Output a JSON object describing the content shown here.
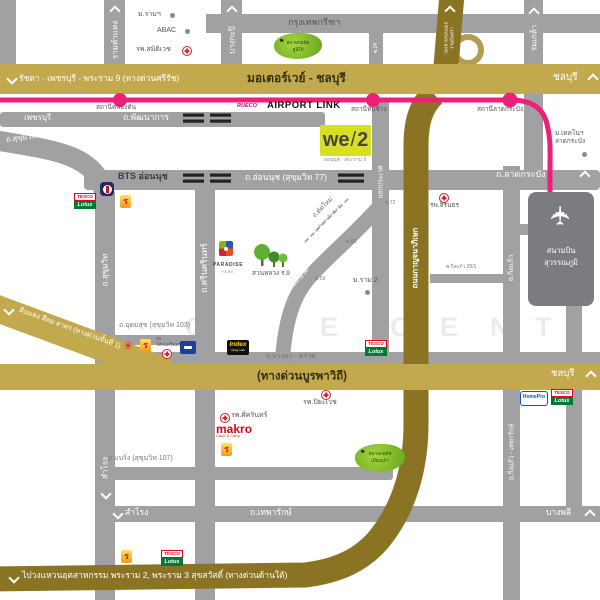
{
  "brand": {
    "we": "we",
    "slash": "/",
    "two": "2",
    "subtitle": "อ่อนนุช - พระราม 9"
  },
  "expressways": {
    "srirat": "รัชดา - เพชรบุรี - พระราม 9 (ทางด่วนศรีรัช)",
    "motorway": "มอเตอร์เวย์ - ชลบุรี",
    "chonburi": "ชลบุรี",
    "outer_ring_line1": "วงแหวนรอบนอก",
    "outer_ring_line2": "รามอินทรา",
    "kanchanaphisek": "ถนนกาญจนาภิเษก",
    "bangna_trat": "ถ.บางนา - ตราด",
    "burapha": "(ทางด่วนบูรพาวิถี)",
    "din_daeng": "ดินแดง สีลม สาทร (ทางด่วนขั้นที่ 1)",
    "industrial_ring": "ไปวงแหวนอุตสาหกรรม พระราม 2, พระราม 3 สุขสวัสดิ์ (ทางด่วนด้านใต้)"
  },
  "airport_link": {
    "label": "AIRPORT LINK",
    "brand": "RUECO",
    "station_khlong_tan": "สถานีคลองตัน",
    "station_thap_chang": "สถานีทับช้าง",
    "station_lat_krabang": "สถานีลาดกระบัง"
  },
  "roads": {
    "ramkhamhaeng": "รามคำแหง",
    "bangkapi": "บางกะปิ",
    "krungthep_kreetha": "กรุงเทพกรีฑา",
    "soi_24": "ซ.24",
    "rom_klao": "ร่มเกล้า",
    "phetchaburi": "เพชรบุรี",
    "phatthanakan": "ถ.พัฒนาการ",
    "sukhumvit": "ถ.สุขุมวิท",
    "on_nut": "ถ.อ่อนนุช (สุขุมวิท 77)",
    "bts_on_nut": "BTS อ่อนนุช",
    "srinagarindra": "ถ.ศรีนครินทร์",
    "lat_krabang": "ถ.ลาดกระบัง",
    "yaek_prawet": "แยกประเวศ",
    "tat_mai": "ถ.ตัดใหม่",
    "tat_mai_sub": "(เฉลิมพระเกียรติ ร.9)",
    "chalerm_prakiat": "เฉลิมพระเกียรติ",
    "soi_72": "ซ.72",
    "soi_62": "ซ.62",
    "soi_59": "ซ.59",
    "king_kaeo": "ถ.กิ่งแก้ว",
    "soi_king_kaeo": "ซ.กิ่งแก้ว 25/1",
    "udom_suk": "ถ.อุดมสุข (สุขุมวิท 103)",
    "bearing": "ถ.แบริ่ง (สุขุมวิท 107)",
    "thepharak": "ถ.เทพารักษ์",
    "samrong": "สำโรง",
    "bang_phli": "บางพลี",
    "king_kaeo_thepharak": "ถ.กิ่งแก้ว - เทพารักษ์"
  },
  "places": {
    "m_ram": "ม.รามฯ",
    "abac": "ABAC",
    "samitivej": "รพ.สมิติเวช",
    "golf_unico_1": "สนามกอล์ฟ",
    "golf_unico_2": "ยูนิโก้",
    "kmitl_1": "ม.เทคโนฯ",
    "kmitl_2": "ลาดกระบัง",
    "sirindhorn": "รพ.สิรินธร",
    "airport_1": "สนามบิน",
    "airport_2": "สุวรรณภูมิ",
    "paradise": "PARADISE",
    "paradise_sub": "PARK",
    "suan_luang": "สวนหลวง ร.9",
    "m_ram_2": "ม.ราม 2",
    "thai_nakarin_1": "รพ.",
    "thai_nakarin_2": "ไทยนครินทร์",
    "piyavate": "รพ.ปิยะเวช",
    "sikarin": "รพ.ศิครินทร์",
    "makro": "makro",
    "makro_sub": "Cash & Carry",
    "golf_muang_kaeo_1": "สนามกอล์ฟ",
    "golf_muang_kaeo_2": "เมืองแก้ว",
    "tesco": "TESCO",
    "lotus": "Lotus",
    "index": "Index",
    "index_sub": "living mall",
    "homepro": "HomePro"
  },
  "watermark": {
    "l1": "A",
    "l2": "O",
    "l3": "E",
    "l4": "C",
    "l5": "E",
    "l6": "N",
    "l7": "T"
  },
  "colors": {
    "pink": "#ec1f79",
    "gold": "#c3a94d",
    "dark_gold": "#8a7423",
    "lime": "#d7df23",
    "road": "#a1a1a4"
  }
}
